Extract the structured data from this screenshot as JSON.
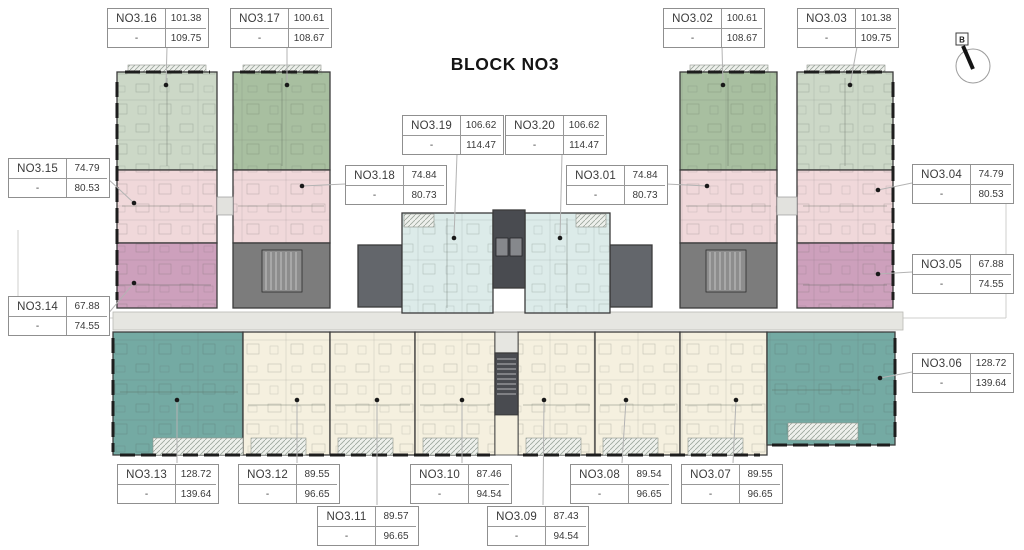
{
  "title": "BLOCK NO3",
  "compass": {
    "label": "B"
  },
  "palette": {
    "sage_light": "#ccd8c7",
    "sage": "#a8bfa0",
    "pink": "#f0d8da",
    "mauve": "#cda0bc",
    "cyan": "#dcebe9",
    "teal": "#74aaa3",
    "cream": "#f5f0df",
    "core": "#7c7c7c",
    "core_dark": "#63666b",
    "shaft": "#494b50",
    "corridor": "#e6e6e1",
    "balcony": "#eef0ec"
  },
  "units": {
    "n01": {
      "name": "NO3.01",
      "area1": "74.84",
      "dash": "-",
      "area2": "80.73"
    },
    "n02": {
      "name": "NO3.02",
      "area1": "100.61",
      "dash": "-",
      "area2": "108.67"
    },
    "n03": {
      "name": "NO3.03",
      "area1": "101.38",
      "dash": "-",
      "area2": "109.75"
    },
    "n04": {
      "name": "NO3.04",
      "area1": "74.79",
      "dash": "-",
      "area2": "80.53"
    },
    "n05": {
      "name": "NO3.05",
      "area1": "67.88",
      "dash": "-",
      "area2": "74.55"
    },
    "n06": {
      "name": "NO3.06",
      "area1": "128.72",
      "dash": "-",
      "area2": "139.64"
    },
    "n07": {
      "name": "NO3.07",
      "area1": "89.55",
      "dash": "-",
      "area2": "96.65"
    },
    "n08": {
      "name": "NO3.08",
      "area1": "89.54",
      "dash": "-",
      "area2": "96.65"
    },
    "n09": {
      "name": "NO3.09",
      "area1": "87.43",
      "dash": "-",
      "area2": "94.54"
    },
    "n10": {
      "name": "NO3.10",
      "area1": "87.46",
      "dash": "-",
      "area2": "94.54"
    },
    "n11": {
      "name": "NO3.11",
      "area1": "89.57",
      "dash": "-",
      "area2": "96.65"
    },
    "n12": {
      "name": "NO3.12",
      "area1": "89.55",
      "dash": "-",
      "area2": "96.65"
    },
    "n13": {
      "name": "NO3.13",
      "area1": "128.72",
      "dash": "-",
      "area2": "139.64"
    },
    "n14": {
      "name": "NO3.14",
      "area1": "67.88",
      "dash": "-",
      "area2": "74.55"
    },
    "n15": {
      "name": "NO3.15",
      "area1": "74.79",
      "dash": "-",
      "area2": "80.53"
    },
    "n16": {
      "name": "NO3.16",
      "area1": "101.38",
      "dash": "-",
      "area2": "109.75"
    },
    "n17": {
      "name": "NO3.17",
      "area1": "100.61",
      "dash": "-",
      "area2": "108.67"
    },
    "n18": {
      "name": "NO3.18",
      "area1": "74.84",
      "dash": "-",
      "area2": "80.73"
    },
    "n19": {
      "name": "NO3.19",
      "area1": "106.62",
      "dash": "-",
      "area2": "114.47"
    },
    "n20": {
      "name": "NO3.20",
      "area1": "106.62",
      "dash": "-",
      "area2": "114.47"
    }
  }
}
